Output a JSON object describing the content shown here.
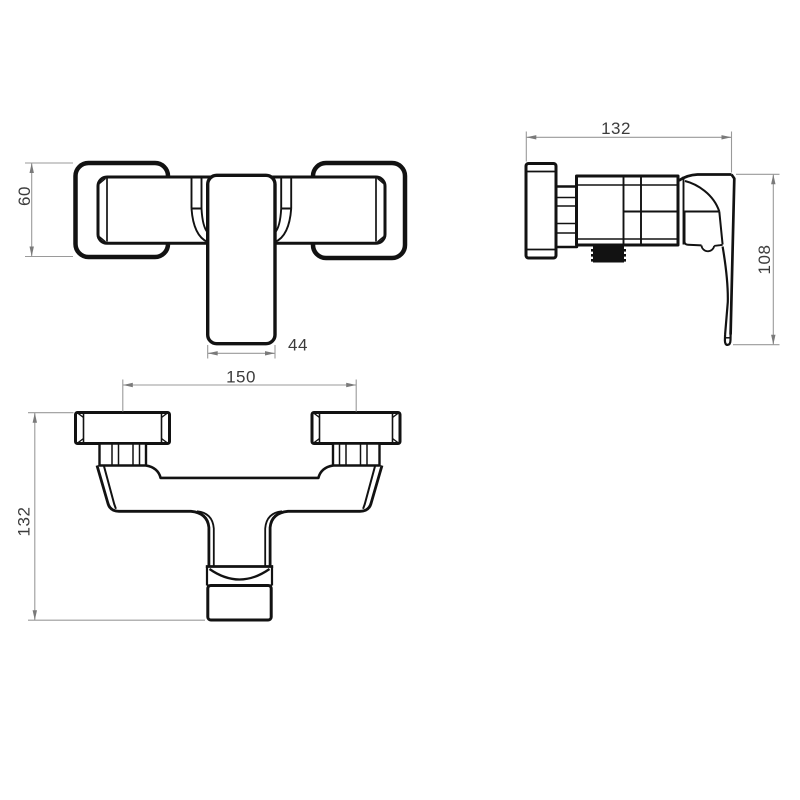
{
  "drawing": {
    "background": "#ffffff",
    "colors": {
      "outline": "#121212",
      "dim_line": "#9a9a9a",
      "arrow": "#7a7a7a",
      "label": "#3c3c3c"
    },
    "views": {
      "front": {
        "dim_height": "60",
        "dim_spout_width": "44"
      },
      "side": {
        "dim_depth": "132",
        "dim_handle_height": "108"
      },
      "bottom": {
        "dim_center_distance": "150",
        "dim_total_depth": "132"
      }
    }
  }
}
